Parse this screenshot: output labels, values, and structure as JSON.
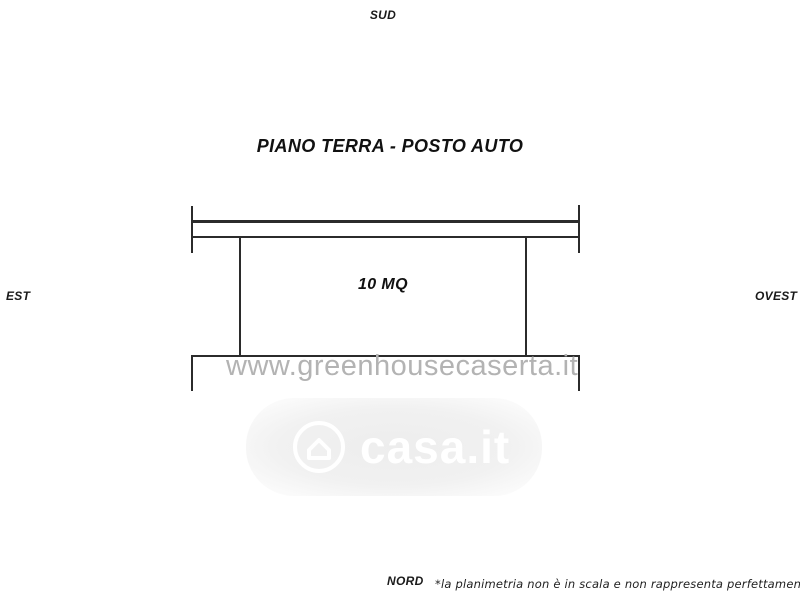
{
  "page": {
    "title": "PIANO TERRA - POSTO AUTO",
    "disclaimer": "*la planimetria non è in scala e non rappresenta perfettamente lo stato dei luoghi"
  },
  "compass": {
    "top": "SUD",
    "bottom": "NORD",
    "left": "EST",
    "right": "OVEST"
  },
  "plan": {
    "area_label": "10 MQ"
  },
  "watermarks": {
    "site": "www.greenhousecaserta.it",
    "portal": "casa.it"
  },
  "colors": {
    "line": "#2b2b2b",
    "text": "#1a1a1a",
    "site_watermark": "#b3b3b3",
    "portal_badge_bg": "#ededed",
    "portal_text": "#ffffff"
  }
}
